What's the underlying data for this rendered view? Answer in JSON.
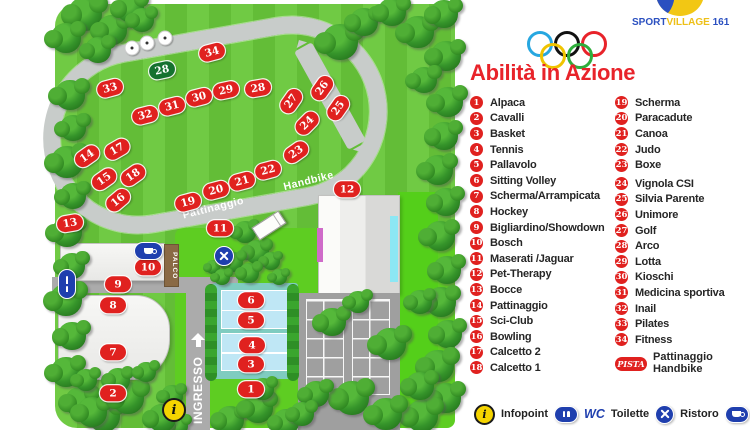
{
  "header": {
    "logo": {
      "sport": "SPORT",
      "village": "VILLAGE",
      "number": "161"
    },
    "title": "Abilità in Azione",
    "olympic_colors": [
      "#27a7e0",
      "#111111",
      "#e8232a",
      "#f0c400",
      "#2fae3c"
    ]
  },
  "legend": {
    "items_col1": [
      {
        "n": "1",
        "label": "Alpaca"
      },
      {
        "n": "2",
        "label": "Cavalli"
      },
      {
        "n": "3",
        "label": "Basket"
      },
      {
        "n": "4",
        "label": "Tennis"
      },
      {
        "n": "5",
        "label": "Pallavolo"
      },
      {
        "n": "6",
        "label": "Sitting Volley"
      },
      {
        "n": "7",
        "label": "Scherma/Arrampicata"
      },
      {
        "n": "8",
        "label": "Hockey"
      },
      {
        "n": "9",
        "label": "Bigliardino/Showdown"
      },
      {
        "n": "10",
        "label": "Bosch"
      },
      {
        "n": "11",
        "label": "Maserati /Jaguar"
      },
      {
        "n": "12",
        "label": "Pet-Therapy"
      },
      {
        "n": "13",
        "label": "Bocce"
      },
      {
        "n": "14",
        "label": "Pattinaggio"
      },
      {
        "n": "15",
        "label": "Sci-Club"
      },
      {
        "n": "16",
        "label": "Bowling"
      },
      {
        "n": "17",
        "label": "Calcetto 2"
      },
      {
        "n": "18",
        "label": "Calcetto 1"
      }
    ],
    "items_col2": [
      {
        "n": "19",
        "label": "Scherma"
      },
      {
        "n": "20",
        "label": "Paracadute"
      },
      {
        "n": "21",
        "label": "Canoa"
      },
      {
        "n": "22",
        "label": "Judo"
      },
      {
        "n": "23",
        "label": "Boxe"
      },
      {
        "n": "24",
        "label": "Vignola CSI"
      },
      {
        "n": "25",
        "label": "Silvia Parente"
      },
      {
        "n": "26",
        "label": "Unimore"
      },
      {
        "n": "27",
        "label": "Golf"
      },
      {
        "n": "28",
        "label": "Arco"
      },
      {
        "n": "29",
        "label": "Lotta"
      },
      {
        "n": "30",
        "label": "Kioschi"
      },
      {
        "n": "31",
        "label": "Medicina sportiva"
      },
      {
        "n": "32",
        "label": "Inail"
      },
      {
        "n": "33",
        "label": "Pilates"
      },
      {
        "n": "34",
        "label": "Fitness"
      }
    ],
    "pista": {
      "badge": "PISTA",
      "line1": "Pattinaggio",
      "line2": "Handbike"
    },
    "footer": {
      "infopoint": "Infopoint",
      "wc": "WC",
      "toilette": "Toilette",
      "ristoro": "Ristoro",
      "bar": "Bar"
    }
  },
  "map": {
    "labels": {
      "pattinaggio": "Pattinaggio",
      "handbike": "Handbike",
      "ingresso": "INGRESSO",
      "palco": "PALCO"
    },
    "markers": [
      {
        "n": "1",
        "x": 251,
        "y": 389,
        "r": 0
      },
      {
        "n": "2",
        "x": 113,
        "y": 393,
        "r": 0
      },
      {
        "n": "3",
        "x": 251,
        "y": 364,
        "r": 0
      },
      {
        "n": "4",
        "x": 252,
        "y": 345,
        "r": 0
      },
      {
        "n": "5",
        "x": 251,
        "y": 320,
        "r": 0
      },
      {
        "n": "6",
        "x": 251,
        "y": 300,
        "r": 0
      },
      {
        "n": "7",
        "x": 113,
        "y": 352,
        "r": 0
      },
      {
        "n": "8",
        "x": 113,
        "y": 305,
        "r": 0
      },
      {
        "n": "9",
        "x": 118,
        "y": 284,
        "r": 0
      },
      {
        "n": "10",
        "x": 148,
        "y": 267,
        "r": 0
      },
      {
        "n": "11",
        "x": 220,
        "y": 228,
        "r": 0
      },
      {
        "n": "12",
        "x": 347,
        "y": 189,
        "r": 0
      },
      {
        "n": "13",
        "x": 70,
        "y": 223,
        "r": -10
      },
      {
        "n": "14",
        "x": 87,
        "y": 156,
        "r": -35
      },
      {
        "n": "15",
        "x": 104,
        "y": 179,
        "r": -35
      },
      {
        "n": "16",
        "x": 118,
        "y": 200,
        "r": -40
      },
      {
        "n": "17",
        "x": 117,
        "y": 149,
        "r": -30
      },
      {
        "n": "18",
        "x": 133,
        "y": 175,
        "r": -35
      },
      {
        "n": "19",
        "x": 188,
        "y": 202,
        "r": -15
      },
      {
        "n": "20",
        "x": 216,
        "y": 190,
        "r": -15
      },
      {
        "n": "21",
        "x": 242,
        "y": 181,
        "r": -15
      },
      {
        "n": "22",
        "x": 268,
        "y": 170,
        "r": -15
      },
      {
        "n": "23",
        "x": 296,
        "y": 152,
        "r": -35
      },
      {
        "n": "24",
        "x": 307,
        "y": 123,
        "r": -45
      },
      {
        "n": "25",
        "x": 338,
        "y": 108,
        "r": -55
      },
      {
        "n": "26",
        "x": 322,
        "y": 88,
        "r": -55
      },
      {
        "n": "27",
        "x": 291,
        "y": 101,
        "r": -55
      },
      {
        "n": "28",
        "x": 258,
        "y": 88,
        "r": -10
      },
      {
        "n": "29",
        "x": 226,
        "y": 90,
        "r": -12
      },
      {
        "n": "30",
        "x": 199,
        "y": 97,
        "r": -14
      },
      {
        "n": "31",
        "x": 172,
        "y": 106,
        "r": -14
      },
      {
        "n": "32",
        "x": 145,
        "y": 115,
        "r": -14
      },
      {
        "n": "33",
        "x": 110,
        "y": 88,
        "r": -15
      },
      {
        "n": "34",
        "x": 212,
        "y": 52,
        "r": -15
      },
      {
        "n": "28",
        "x": 162,
        "y": 70,
        "r": -12,
        "c": "green"
      }
    ],
    "targets": [
      [
        132,
        48
      ],
      [
        147,
        43
      ],
      [
        165,
        38
      ]
    ],
    "trees": [
      [
        85,
        14,
        34
      ],
      [
        112,
        30,
        30
      ],
      [
        130,
        8,
        28
      ],
      [
        66,
        38,
        30
      ],
      [
        98,
        50,
        26
      ],
      [
        142,
        20,
        24
      ],
      [
        70,
        95,
        30
      ],
      [
        73,
        128,
        26
      ],
      [
        67,
        162,
        32
      ],
      [
        73,
        196,
        26
      ],
      [
        67,
        232,
        30
      ],
      [
        72,
        266,
        26
      ],
      [
        66,
        300,
        32
      ],
      [
        72,
        336,
        28
      ],
      [
        66,
        372,
        30
      ],
      [
        80,
        402,
        30
      ],
      [
        104,
        416,
        32
      ],
      [
        340,
        42,
        36
      ],
      [
        364,
        22,
        28
      ],
      [
        392,
        12,
        28
      ],
      [
        418,
        32,
        32
      ],
      [
        444,
        14,
        28
      ],
      [
        446,
        56,
        30
      ],
      [
        424,
        80,
        26
      ],
      [
        448,
        102,
        30
      ],
      [
        444,
        136,
        28
      ],
      [
        438,
        170,
        30
      ],
      [
        446,
        202,
        28
      ],
      [
        440,
        236,
        30
      ],
      [
        447,
        270,
        28
      ],
      [
        441,
        302,
        30
      ],
      [
        448,
        334,
        28
      ],
      [
        438,
        366,
        32
      ],
      [
        446,
        398,
        30
      ],
      [
        422,
        416,
        32
      ],
      [
        332,
        322,
        28
      ],
      [
        358,
        302,
        22
      ],
      [
        390,
        344,
        32
      ],
      [
        420,
        302,
        24
      ],
      [
        352,
        398,
        34
      ],
      [
        316,
        394,
        26
      ],
      [
        386,
        414,
        32
      ],
      [
        420,
        386,
        28
      ],
      [
        230,
        420,
        28
      ],
      [
        258,
        408,
        30
      ],
      [
        286,
        422,
        26
      ],
      [
        263,
        389,
        22
      ],
      [
        302,
        414,
        24
      ],
      [
        178,
        426,
        20
      ],
      [
        92,
        412,
        30
      ],
      [
        128,
        398,
        32
      ],
      [
        162,
        418,
        28
      ],
      [
        118,
        380,
        24
      ],
      [
        146,
        372,
        20
      ],
      [
        86,
        380,
        22
      ],
      [
        172,
        396,
        22
      ],
      [
        245,
        232,
        22
      ],
      [
        257,
        252,
        24
      ],
      [
        233,
        262,
        20
      ],
      [
        213,
        267,
        14
      ],
      [
        271,
        261,
        18
      ],
      [
        222,
        277,
        16
      ],
      [
        249,
        273,
        20
      ],
      [
        279,
        277,
        16
      ]
    ]
  },
  "colors": {
    "marker_red": "#e0211f",
    "marker_green": "#15722f",
    "title_red": "#e8232a",
    "icon_blue": "#1f3fae",
    "info_yellow": "#f5d400",
    "track_gray": "#c8ccca",
    "grass": "#68c73a"
  }
}
